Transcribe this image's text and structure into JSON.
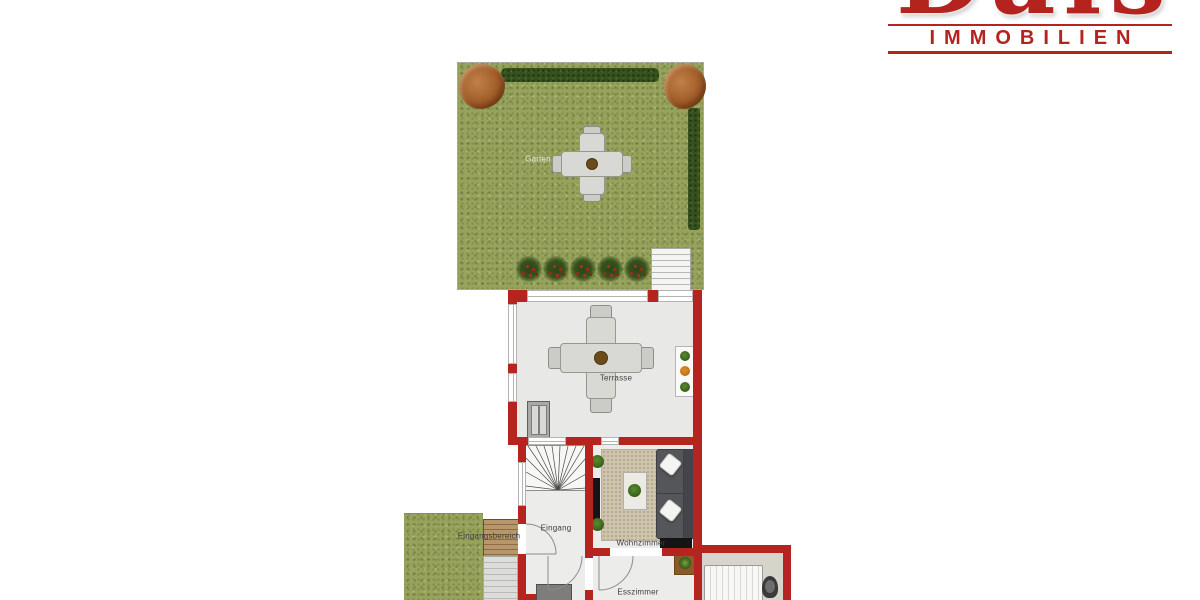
{
  "logo": {
    "brand": "Dais",
    "subtitle": "IMMOBILIEN",
    "color": "#b5231f"
  },
  "floorplan": {
    "labels": {
      "garden": "Garten",
      "terrace": "Terrasse",
      "entrance": "Eingang",
      "living_room": "Wohnzimmer",
      "dining_room": "Esszimmer",
      "entry_area": "Eingangsbereich"
    },
    "colors": {
      "wall": "#b5241f",
      "grass": "#97a35d",
      "hedge": "#36511d",
      "indoor_floor": "#ececea",
      "terrace_floor": "#e8e8e6",
      "bath_floor": "#d7d4cb",
      "rug": "#cec4ad",
      "sofa": "#55565a",
      "deck_wood": "#b5976b",
      "tree": "#a05c28"
    }
  }
}
